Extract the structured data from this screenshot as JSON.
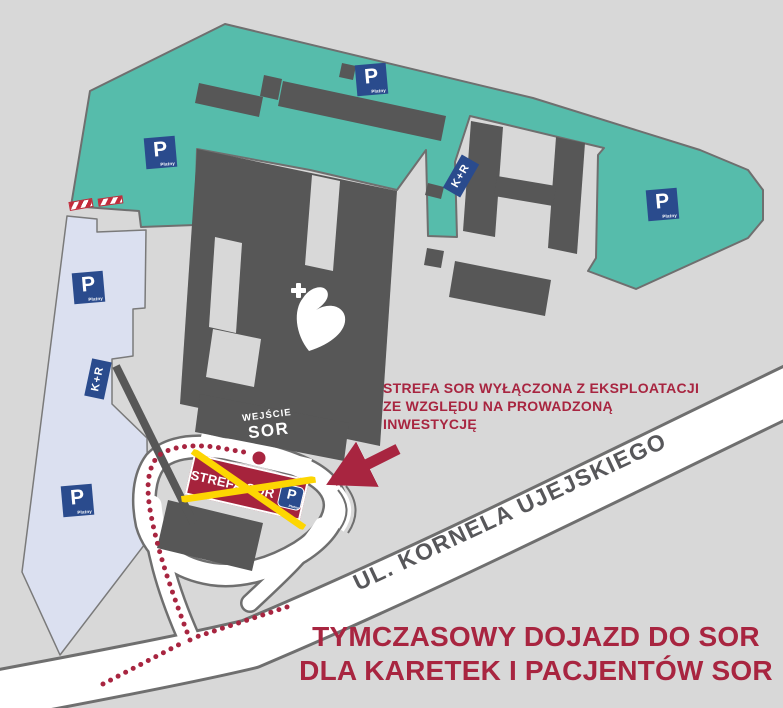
{
  "map": {
    "street_label": "UL. KORNELA UJEJSKIEGO",
    "entrance": {
      "line1": "WEJŚCIE",
      "line2": "SOR"
    },
    "closed_zone_sign": {
      "label": "STREFA SOR",
      "parking_badge": {
        "label": "P",
        "sublabel": "Płatny"
      }
    },
    "annotation": {
      "line1": "STREFA SOR WYŁĄCZONA Z EKSPLOATACJI",
      "line2": "ZE WZGLĘDU NA PROWADZONĄ",
      "line3": "INWESTYCJĘ"
    },
    "title": {
      "line1": "TYMCZASOWY DOJAZD DO SOR",
      "line2": "DLA KARETEK I PACJENTÓW SOR"
    },
    "parking_signs": [
      {
        "label": "P",
        "sublabel": "Płatny"
      },
      {
        "label": "P",
        "sublabel": "Płatny"
      },
      {
        "label": "P",
        "sublabel": "Płatny"
      },
      {
        "label": "P",
        "sublabel": "Płatny"
      },
      {
        "label": "P",
        "sublabel": "Płatny"
      }
    ],
    "kiss_and_ride_signs": [
      {
        "label": "K+R"
      },
      {
        "label": "K+R"
      }
    ],
    "colors": {
      "background": "#d8d8d8",
      "teal_parking_area": "#56bcab",
      "paid_parking_area": "#dbe0f0",
      "buildings": "#575757",
      "road_white": "#ffffff",
      "road_casing": "#6f6f6f",
      "accent_red": "#a82540",
      "sign_red": "#a6233c",
      "cross_yellow": "#fdd602",
      "sign_navy": "#2a4b8d"
    }
  }
}
